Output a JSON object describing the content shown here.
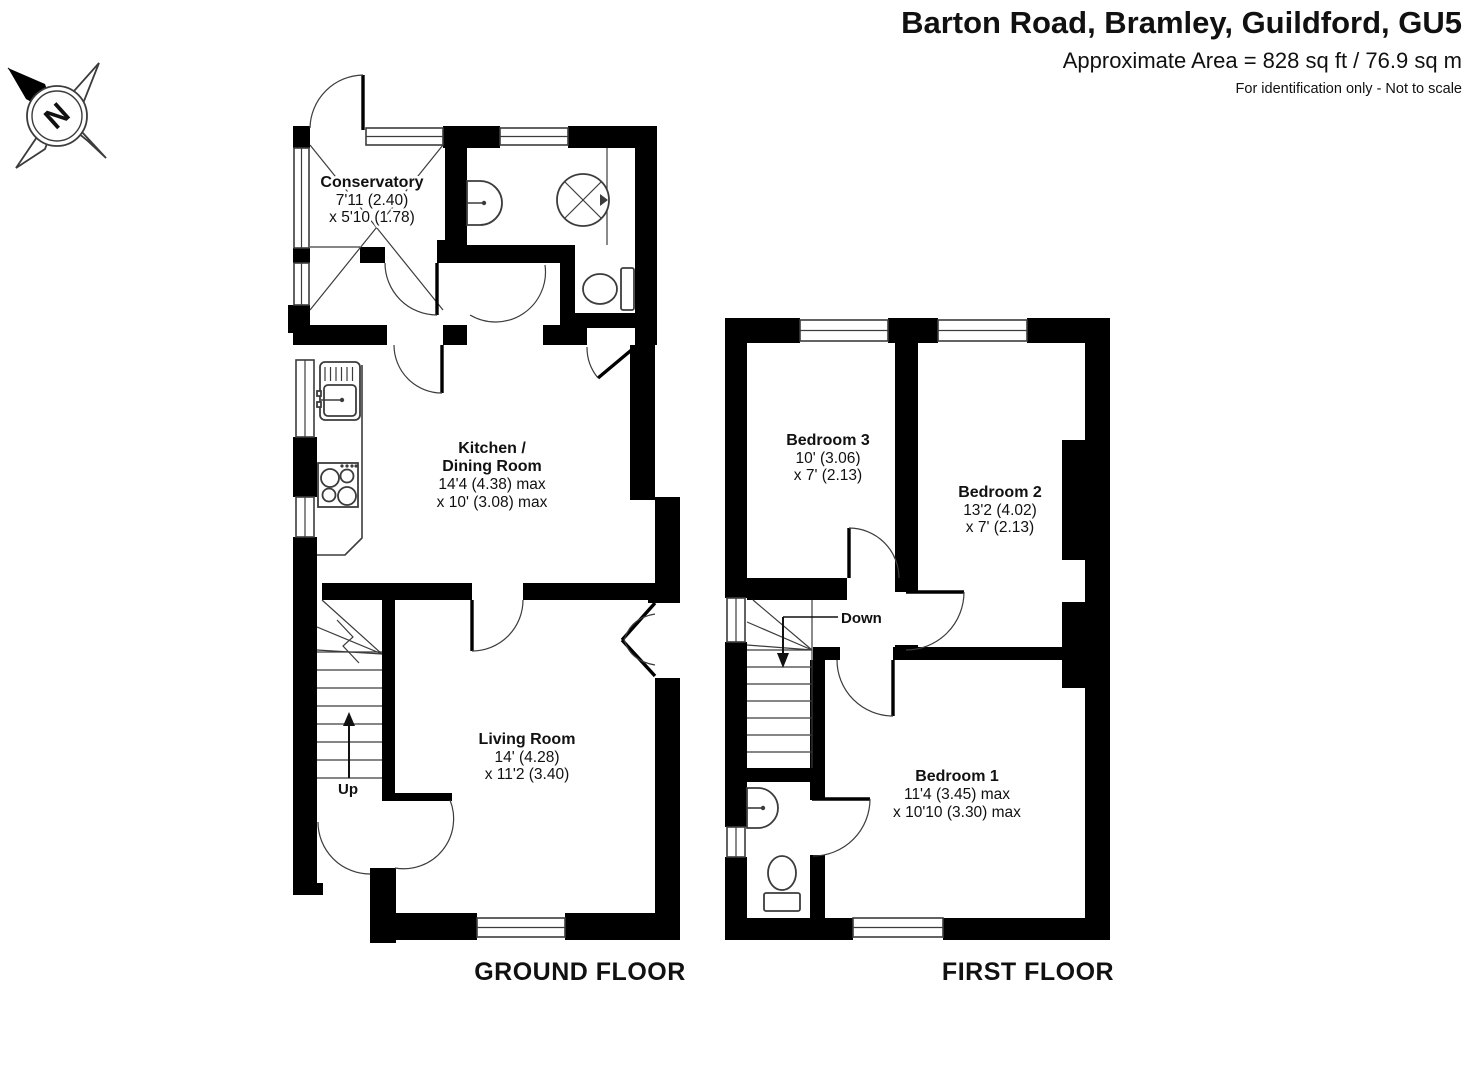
{
  "header": {
    "title": "Barton Road, Bramley, Guildford, GU5",
    "area": "Approximate Area = 828 sq ft / 76.9 sq m",
    "note": "For identification only - Not to scale"
  },
  "compass": {
    "north": "N"
  },
  "ground_floor": {
    "label": "GROUND FLOOR",
    "up_label": "Up",
    "conservatory": {
      "name": "Conservatory",
      "dim1": "7'11 (2.40)",
      "dim2": "x 5'10 (1.78)"
    },
    "kitchen": {
      "name1": "Kitchen /",
      "name2": "Dining Room",
      "dim1": "14'4 (4.38) max",
      "dim2": "x 10' (3.08) max"
    },
    "living_room": {
      "name": "Living Room",
      "dim1": "14' (4.28)",
      "dim2": "x 11'2 (3.40)"
    }
  },
  "first_floor": {
    "label": "FIRST FLOOR",
    "down_label": "Down",
    "bedroom3": {
      "name": "Bedroom 3",
      "dim1": "10' (3.06)",
      "dim2": "x 7' (2.13)"
    },
    "bedroom2": {
      "name": "Bedroom 2",
      "dim1": "13'2 (4.02)",
      "dim2": "x 7' (2.13)"
    },
    "bedroom1": {
      "name": "Bedroom 1",
      "dim1": "11'4 (3.45) max",
      "dim2": "x 10'10 (3.30) max"
    }
  },
  "colors": {
    "wall": "#000000",
    "line": "#3c3c3c",
    "background": "#ffffff",
    "text": "#111111"
  }
}
